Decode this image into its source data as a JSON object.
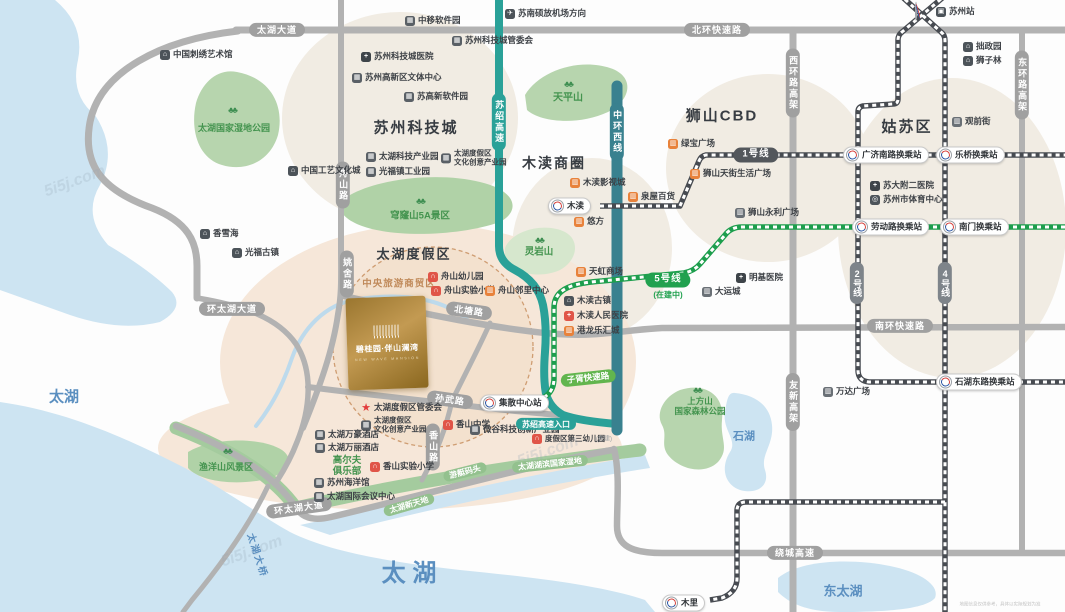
{
  "property": {
    "name": "碧桂园·伴山澜湾",
    "name_en": "NEW WAVE MANSION"
  },
  "colors": {
    "water": "#cde4f2",
    "park": "#b7d5ae",
    "park_band": "#a4cb9e",
    "cream": "#f1ece3",
    "peach": "#f6e7d9",
    "road_gray": "#b2b2b2",
    "expressway_teal": "#2aa198",
    "ring_teal": "#39818f",
    "metro_dark": "#474b51",
    "metro_green": "#1d9e4d",
    "line1_badge": "#53575c",
    "line5_badge": "#21a14f",
    "line24_badge": "#7e848a",
    "shop_orange": "#e8823b",
    "school_red": "#e05548",
    "gold": "#b8914a",
    "lake_text": "#5b8fc0"
  },
  "icon_styles": {
    "museum-icon": {
      "bg": "#4c5359",
      "glyph": "⌂"
    },
    "building-icon": {
      "bg": "#5a6066",
      "glyph": "▦"
    },
    "hospital-icon": {
      "bg": "#3e4449",
      "glyph": "+"
    },
    "hospital-red-icon": {
      "bg": "#e05548",
      "glyph": "+"
    },
    "school-icon": {
      "bg": "#e05548",
      "glyph": "∩"
    },
    "shop-icon": {
      "bg": "#e8823b",
      "glyph": "▥"
    },
    "shop-gray-icon": {
      "bg": "#6a7076",
      "glyph": "▥"
    },
    "plane-icon": {
      "bg": "#4c5359",
      "glyph": "✈"
    },
    "train-icon": {
      "bg": "#4c5359",
      "glyph": "▣"
    },
    "sports-icon": {
      "bg": "#4c5359",
      "glyph": "◎"
    },
    "star-icon": {
      "fg": "#e23c3c",
      "glyph": "★"
    }
  },
  "labels": [
    {
      "k": "region",
      "t": "苏州科技城",
      "x": 416,
      "y": 128,
      "fs": 15,
      "n": "region-suzhou-science-city"
    },
    {
      "k": "region",
      "t": "木渎商圈",
      "x": 554,
      "y": 163,
      "fs": 14,
      "n": "region-mudu-business-area"
    },
    {
      "k": "region",
      "t": "狮山CBD",
      "x": 722,
      "y": 116,
      "fs": 15,
      "n": "region-shishan-cbd"
    },
    {
      "k": "region",
      "t": "姑苏区",
      "x": 907,
      "y": 127,
      "fs": 15,
      "n": "region-gusu-district"
    },
    {
      "k": "region",
      "t": "太湖度假区",
      "x": 414,
      "y": 255,
      "fs": 13,
      "n": "region-taihu-resort"
    },
    {
      "k": "region-sub",
      "t": "中央旅游商贸区",
      "x": 399,
      "y": 285,
      "fs": 9.5,
      "n": "central-tourism-trade-zone"
    },
    {
      "k": "lake",
      "t": "太湖",
      "x": 64,
      "y": 397,
      "fs": 15,
      "n": "lake-taihu-west"
    },
    {
      "k": "lake",
      "t": "太 湖",
      "x": 409,
      "y": 574,
      "fs": 24,
      "n": "lake-taihu-south"
    },
    {
      "k": "lake",
      "t": "东太湖",
      "x": 843,
      "y": 592,
      "fs": 13,
      "n": "lake-east-taihu"
    },
    {
      "k": "lake",
      "t": "石湖",
      "x": 744,
      "y": 437,
      "fs": 11,
      "n": "lake-shihu"
    },
    {
      "k": "bridge",
      "t": "太湖大桥",
      "x": 256,
      "y": 556,
      "rot": 72,
      "n": "taihu-bridge-label"
    },
    {
      "k": "tree",
      "t": "♣♣",
      "x": 232,
      "y": 110,
      "n": "tree-icon"
    },
    {
      "k": "tree",
      "t": "♣♣",
      "x": 420,
      "y": 201,
      "n": "tree-icon"
    },
    {
      "k": "tree",
      "t": "♣♣",
      "x": 568,
      "y": 84,
      "n": "tree-icon"
    },
    {
      "k": "tree",
      "t": "♣♣",
      "x": 539,
      "y": 240,
      "n": "tree-icon"
    },
    {
      "k": "tree",
      "t": "♣♣",
      "x": 227,
      "y": 451,
      "n": "tree-icon"
    },
    {
      "k": "tree",
      "t": "♣♣",
      "x": 697,
      "y": 390,
      "n": "tree-icon"
    },
    {
      "k": "park",
      "t": "太湖国家湿地公园",
      "x": 234,
      "y": 128,
      "fs": 9,
      "n": "park-taihu-wetland"
    },
    {
      "k": "park",
      "t": "穹窿山5A景区",
      "x": 420,
      "y": 217,
      "fs": 9.5,
      "n": "park-qionglongshan"
    },
    {
      "k": "park",
      "t": "天平山",
      "x": 568,
      "y": 98,
      "fs": 10,
      "n": "park-tianpingshan"
    },
    {
      "k": "park",
      "t": "灵岩山",
      "x": 539,
      "y": 253,
      "fs": 9.5,
      "n": "park-lingyanshan"
    },
    {
      "k": "park",
      "t": "渔洋山风景区",
      "x": 226,
      "y": 467,
      "fs": 9,
      "n": "park-yuyangshan"
    },
    {
      "k": "park2",
      "t": "上方山\n国家森林公园",
      "x": 700,
      "y": 407,
      "fs": 8.5,
      "n": "park-shangfangshan"
    },
    {
      "k": "park2",
      "t": "高尔夫\n俱乐部",
      "x": 347,
      "y": 467,
      "fs": 9.5,
      "n": "golf-club-label"
    },
    {
      "k": "ribbon",
      "t": "游艇码头",
      "x": 465,
      "y": 472,
      "rot": -14,
      "n": "yacht-dock-label"
    },
    {
      "k": "ribbon",
      "t": "太湖新天地",
      "x": 409,
      "y": 505,
      "rot": -16,
      "n": "taihu-xintiandi-label"
    },
    {
      "k": "ribbon",
      "t": "太湖湖滨国家湿地",
      "x": 550,
      "y": 464,
      "rot": -6,
      "n": "taihu-lakeside-wetland-label"
    },
    {
      "k": "road-h",
      "t": "太湖大道",
      "x": 277,
      "y": 30,
      "n": "road-taihu-avenue"
    },
    {
      "k": "road-h",
      "t": "北环快速路",
      "x": 717,
      "y": 30,
      "n": "road-north-ring"
    },
    {
      "k": "road-h",
      "t": "环太湖大道",
      "x": 232,
      "y": 309,
      "n": "road-huantaihu-avenue-n"
    },
    {
      "k": "road-h",
      "t": "环太湖大道",
      "x": 299,
      "y": 508,
      "rot": -8,
      "n": "road-huantaihu-avenue-s"
    },
    {
      "k": "road-h",
      "t": "北塘路",
      "x": 469,
      "y": 311,
      "rot": 8,
      "n": "road-beitang"
    },
    {
      "k": "road-h",
      "t": "孙武路",
      "x": 450,
      "y": 400,
      "rot": 8,
      "n": "road-sunwu"
    },
    {
      "k": "road-h",
      "t": "南环快速路",
      "x": 900,
      "y": 326,
      "n": "road-south-ring"
    },
    {
      "k": "road-h",
      "t": "绕城高速",
      "x": 795,
      "y": 553,
      "n": "road-raocheng-expressway"
    },
    {
      "k": "road-v",
      "t": "舟山路",
      "x": 343,
      "y": 185,
      "n": "road-zhoushan"
    },
    {
      "k": "road-v",
      "t": "姚舍路",
      "x": 347,
      "y": 274,
      "n": "road-yaoshe"
    },
    {
      "k": "road-v",
      "t": "香山路",
      "x": 433,
      "y": 447,
      "n": "road-xiangshan"
    },
    {
      "k": "road-v",
      "t": "西环路高架",
      "x": 793,
      "y": 83,
      "n": "road-west-ring-viaduct"
    },
    {
      "k": "road-v",
      "t": "东环路高架",
      "x": 1022,
      "y": 85,
      "n": "road-east-ring-viaduct"
    },
    {
      "k": "road-v",
      "t": "友新高架",
      "x": 793,
      "y": 402,
      "n": "road-youxin-viaduct"
    },
    {
      "k": "road-v",
      "t": "苏绍高速",
      "x": 499,
      "y": 122,
      "bg": "#2aa198",
      "n": "road-sushao-expressway"
    },
    {
      "k": "road-v",
      "t": "中环西线",
      "x": 617,
      "y": 132,
      "bg": "#39818f",
      "n": "road-middle-ring-west"
    },
    {
      "k": "pill",
      "t": "苏绍高速入口",
      "x": 546,
      "y": 424,
      "bg": "#2aa198",
      "n": "sushao-expressway-entrance"
    },
    {
      "k": "pill",
      "t": "子胥快速路",
      "x": 588,
      "y": 378,
      "bg": "#62b54e",
      "rot": -6,
      "fs": 8.5,
      "n": "road-zixu-expressway"
    },
    {
      "k": "badge",
      "t": "1号线",
      "x": 756,
      "y": 155,
      "bg": "#53575c",
      "n": "metro-line1-badge"
    },
    {
      "k": "badge",
      "t": "5号线",
      "x": 668,
      "y": 280,
      "bg": "#21a14f",
      "n": "metro-line5-badge"
    },
    {
      "k": "note",
      "t": "(在建中)",
      "x": 668,
      "y": 295,
      "n": "line5-under-construction-note"
    },
    {
      "k": "badge-v",
      "t": "2号线",
      "x": 857,
      "y": 283,
      "bg": "#7e848a",
      "n": "metro-line2-badge"
    },
    {
      "k": "badge-v",
      "t": "4号线",
      "x": 945,
      "y": 283,
      "bg": "#7e848a",
      "n": "metro-line4-badge"
    },
    {
      "k": "mroundel",
      "t": "",
      "x": 915,
      "y": 12,
      "n": "suzhou-metro-logo"
    },
    {
      "k": "station",
      "t": "木渎",
      "x": 548,
      "y": 206,
      "n": "metro-station-mudu"
    },
    {
      "k": "station",
      "t": "广济南路换乘站",
      "x": 843,
      "y": 155,
      "n": "metro-station-guangjinanlu"
    },
    {
      "k": "station",
      "t": "乐桥换乘站",
      "x": 936,
      "y": 155,
      "n": "metro-station-leqiao"
    },
    {
      "k": "station",
      "t": "劳动路换乘站",
      "x": 852,
      "y": 227,
      "n": "metro-station-laodonglu"
    },
    {
      "k": "station",
      "t": "南门换乘站",
      "x": 940,
      "y": 227,
      "n": "metro-station-nanmen"
    },
    {
      "k": "station",
      "t": "石湖东路换乘站",
      "x": 936,
      "y": 382,
      "n": "metro-station-shihudonglu"
    },
    {
      "k": "station",
      "t": "集散中心站",
      "x": 480,
      "y": 403,
      "n": "metro-station-jisan-center"
    },
    {
      "k": "station",
      "t": "木里",
      "x": 662,
      "y": 603,
      "n": "metro-station-muli"
    },
    {
      "k": "poi",
      "t": "苏州站",
      "icon": "train-icon",
      "x": 936,
      "y": 12,
      "n": "poi-suzhou-railway-station"
    },
    {
      "k": "poi",
      "t": "中移软件园",
      "icon": "building-icon",
      "x": 405,
      "y": 21,
      "n": "poi-zhongyi-software-park"
    },
    {
      "k": "poi",
      "t": "苏南硕放机场方向",
      "icon": "plane-icon",
      "x": 505,
      "y": 14,
      "n": "poi-airport-direction"
    },
    {
      "k": "poi",
      "t": "苏州科技城管委会",
      "icon": "building-icon",
      "x": 452,
      "y": 41,
      "n": "poi-sst-admin"
    },
    {
      "k": "poi",
      "t": "苏州科技城医院",
      "icon": "hospital-icon",
      "x": 361,
      "y": 57,
      "n": "poi-sst-hospital"
    },
    {
      "k": "poi",
      "t": "苏州高新区文体中心",
      "icon": "building-icon",
      "x": 352,
      "y": 78,
      "n": "poi-snd-culture-sports"
    },
    {
      "k": "poi",
      "t": "苏高新软件园",
      "icon": "building-icon",
      "x": 404,
      "y": 97,
      "n": "poi-sugaoxin-software-park"
    },
    {
      "k": "poi",
      "t": "中国刺绣艺术馆",
      "icon": "museum-icon",
      "x": 160,
      "y": 55,
      "n": "poi-embroidery-museum"
    },
    {
      "k": "poi",
      "t": "中国工艺文化城",
      "icon": "museum-icon",
      "x": 288,
      "y": 171,
      "n": "poi-craft-culture-city"
    },
    {
      "k": "poi",
      "t": "太湖科技产业园",
      "icon": "building-icon",
      "x": 366,
      "y": 157,
      "n": "poi-taihu-tech-park"
    },
    {
      "k": "poi",
      "t": "光福镇工业园",
      "icon": "building-icon",
      "x": 366,
      "y": 172,
      "n": "poi-guangfu-industrial-park"
    },
    {
      "k": "poi",
      "t": "太湖度假区\n文化创意产业园",
      "icon": "building-icon",
      "x": 441,
      "y": 158,
      "fs": 7.5,
      "n": "poi-cultural-creative-park-n"
    },
    {
      "k": "poi",
      "t": "香雪海",
      "icon": "museum-icon",
      "x": 200,
      "y": 234,
      "n": "poi-xiangxuehai"
    },
    {
      "k": "poi",
      "t": "光福古镇",
      "icon": "museum-icon",
      "x": 232,
      "y": 253,
      "n": "poi-guangfu-old-town"
    },
    {
      "k": "poi",
      "t": "木渎影视城",
      "icon": "shop-icon",
      "x": 570,
      "y": 183,
      "n": "poi-mudu-film-city"
    },
    {
      "k": "poi",
      "t": "悠方",
      "icon": "shop-icon",
      "x": 574,
      "y": 222,
      "n": "poi-youfang"
    },
    {
      "k": "poi",
      "t": "泉屋百货",
      "icon": "shop-icon",
      "x": 628,
      "y": 197,
      "n": "poi-izumiya"
    },
    {
      "k": "poi",
      "t": "天虹商场",
      "icon": "shop-icon",
      "x": 576,
      "y": 272,
      "n": "poi-tianhong-mall"
    },
    {
      "k": "poi",
      "t": "木渎古镇",
      "icon": "museum-icon",
      "x": 564,
      "y": 301,
      "n": "poi-mudu-old-town"
    },
    {
      "k": "poi",
      "t": "木渎人民医院",
      "icon": "hospital-red-icon",
      "x": 564,
      "y": 316,
      "n": "poi-mudu-hospital"
    },
    {
      "k": "poi",
      "t": "港龙乐汇城",
      "icon": "shop-icon",
      "x": 564,
      "y": 331,
      "n": "poi-ganglong-mall"
    },
    {
      "k": "poi",
      "t": "绿宝广场",
      "icon": "shop-icon",
      "x": 668,
      "y": 144,
      "n": "poi-lvbao-plaza"
    },
    {
      "k": "poi",
      "t": "狮山天街生活广场",
      "icon": "shop-icon",
      "x": 690,
      "y": 174,
      "n": "poi-shishan-tianjie"
    },
    {
      "k": "poi",
      "t": "狮山永利广场",
      "icon": "shop-gray-icon",
      "x": 735,
      "y": 213,
      "n": "poi-shishan-yongli"
    },
    {
      "k": "poi",
      "t": "明基医院",
      "icon": "hospital-icon",
      "x": 736,
      "y": 278,
      "n": "poi-benq-hospital"
    },
    {
      "k": "poi",
      "t": "大运城",
      "icon": "shop-gray-icon",
      "x": 702,
      "y": 292,
      "n": "poi-dayuncheng"
    },
    {
      "k": "poi",
      "t": "拙政园",
      "icon": "museum-icon",
      "x": 963,
      "y": 47,
      "n": "poi-humble-admin-garden"
    },
    {
      "k": "poi",
      "t": "狮子林",
      "icon": "museum-icon",
      "x": 963,
      "y": 61,
      "n": "poi-lion-grove"
    },
    {
      "k": "poi",
      "t": "观前街",
      "icon": "shop-gray-icon",
      "x": 952,
      "y": 122,
      "n": "poi-guanqian-street"
    },
    {
      "k": "poi",
      "t": "苏大附二医院",
      "icon": "hospital-icon",
      "x": 870,
      "y": 186,
      "n": "poi-suda-hospital"
    },
    {
      "k": "poi",
      "t": "苏州市体育中心",
      "icon": "sports-icon",
      "x": 870,
      "y": 200,
      "n": "poi-sports-center"
    },
    {
      "k": "poi",
      "t": "万达广场",
      "icon": "shop-gray-icon",
      "x": 823,
      "y": 392,
      "n": "poi-wanda-plaza"
    },
    {
      "k": "poi",
      "t": "舟山幼儿园",
      "icon": "school-icon",
      "x": 428,
      "y": 277,
      "n": "poi-zhoushan-kindergarten"
    },
    {
      "k": "poi",
      "t": "舟山实验小学",
      "icon": "school-icon",
      "x": 431,
      "y": 291,
      "n": "poi-zhoushan-primary"
    },
    {
      "k": "poi",
      "t": "舟山邻里中心",
      "icon": "shop-icon",
      "x": 485,
      "y": 291,
      "n": "poi-zhoushan-neighborhood"
    },
    {
      "k": "poi",
      "t": "太湖度假区管委会",
      "icon": "star-icon",
      "x": 361,
      "y": 408,
      "n": "poi-resort-admin"
    },
    {
      "k": "poi",
      "t": "太湖度假区\n文化创意产业园",
      "icon": "building-icon",
      "x": 361,
      "y": 425,
      "fs": 7.5,
      "n": "poi-cultural-creative-park-s"
    },
    {
      "k": "poi",
      "t": "太湖万豪酒店",
      "icon": "building-icon",
      "x": 315,
      "y": 435,
      "n": "poi-marriott-hotel"
    },
    {
      "k": "poi",
      "t": "太湖万丽酒店",
      "icon": "building-icon",
      "x": 315,
      "y": 448,
      "n": "poi-renaissance-hotel"
    },
    {
      "k": "poi",
      "t": "香山实验小学",
      "icon": "school-icon",
      "x": 370,
      "y": 467,
      "n": "poi-xiangshan-primary"
    },
    {
      "k": "poi",
      "t": "香山中学",
      "icon": "school-icon",
      "x": 443,
      "y": 425,
      "n": "poi-xiangshan-middle-school"
    },
    {
      "k": "poi",
      "t": "微谷科技创新产业园",
      "icon": "building-icon",
      "x": 470,
      "y": 430,
      "n": "poi-weigu-tech-park"
    },
    {
      "k": "poi",
      "t": "度假区第三幼儿园",
      "icon": "school-icon",
      "x": 532,
      "y": 439,
      "fs": 7.5,
      "n": "poi-resort-third-kindergarten"
    },
    {
      "k": "tiny",
      "t": "(在建)",
      "x": 604,
      "y": 440,
      "n": "under-construction-note"
    },
    {
      "k": "poi",
      "t": "苏州海洋馆",
      "icon": "building-icon",
      "x": 314,
      "y": 483,
      "n": "poi-suzhou-aquarium"
    },
    {
      "k": "poi",
      "t": "太湖国际会议中心",
      "icon": "building-icon",
      "x": 314,
      "y": 497,
      "n": "poi-taihu-convention-center"
    },
    {
      "k": "wm",
      "t": "5i5j.com",
      "x": 75,
      "y": 182,
      "rot": -20,
      "n": "watermark"
    },
    {
      "k": "wm",
      "t": "5i5j.com",
      "x": 548,
      "y": 452,
      "rot": -20,
      "n": "watermark"
    },
    {
      "k": "wm",
      "t": "5i5j.com",
      "x": 252,
      "y": 552,
      "rot": -20,
      "n": "watermark"
    },
    {
      "k": "tiny-gray",
      "t": "地图信息仅供参考，具体以实际规划为准",
      "x": 1000,
      "y": 604,
      "n": "map-disclaimer"
    }
  ]
}
